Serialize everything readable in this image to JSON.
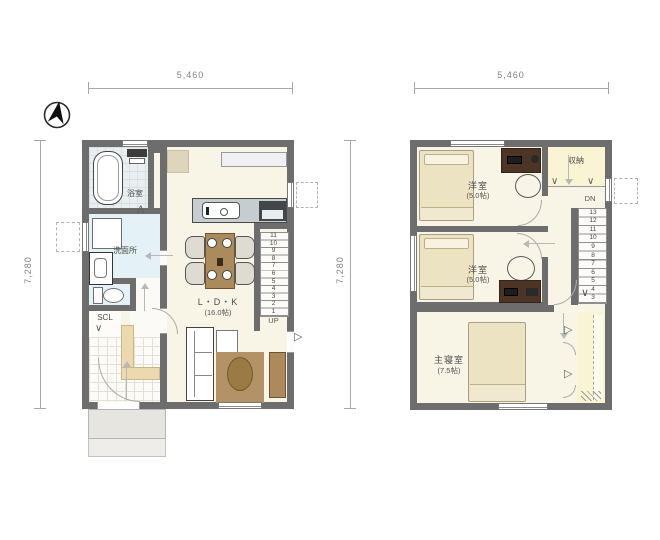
{
  "compass": {
    "icon": "north-arrow"
  },
  "colors": {
    "wall": "#6d6d6d",
    "floor_cream": "#f8f4e6",
    "pale_yellow": "#f9f5d4",
    "light_blue": "#e4f2f7",
    "wood_brown": "#ab8a5c",
    "dark_wood": "#4d3526"
  },
  "floor1": {
    "width_label": "5,460",
    "height_label": "7,280",
    "bath_label": "浴室",
    "washroom_label": "洗面所",
    "scl_label": "SCL",
    "ldk_label": "L・D・K",
    "ldk_size_label": "(16.0帖)",
    "stairs_up_label": "UP",
    "stair_numbers": [
      "11",
      "10",
      "9",
      "8",
      "7",
      "6",
      "5",
      "4",
      "3",
      "2",
      "1"
    ]
  },
  "floor2": {
    "width_label": "5,460",
    "height_label": "7,280",
    "bedroom1_label": "洋室",
    "bedroom1_size_label": "(5.0帖)",
    "bedroom2_label": "洋室",
    "bedroom2_size_label": "(5.0帖)",
    "master_label": "主寝室",
    "master_size_label": "(7.5帖)",
    "storage_label": "収納",
    "stairs_down_label": "DN",
    "stair_numbers": [
      "13",
      "12",
      "11",
      "10",
      "9",
      "8",
      "7",
      "6",
      "5",
      "4",
      "3"
    ]
  }
}
